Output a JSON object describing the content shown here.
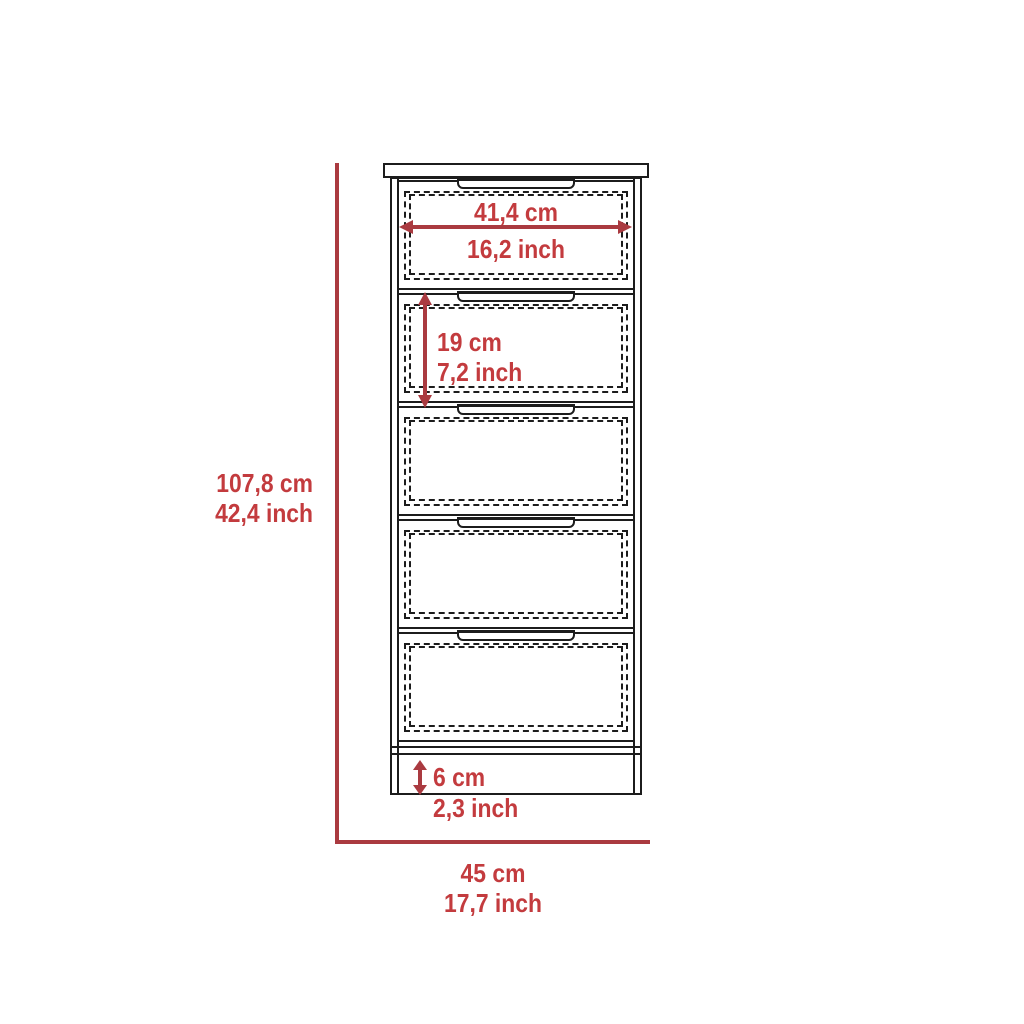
{
  "colors": {
    "dimension_line": "#aa3a40",
    "dimension_text": "#c33b3e",
    "outline": "#1c1c1c",
    "background": "#ffffff"
  },
  "diagram": {
    "object": "chest-of-drawers",
    "drawer_count": "5",
    "dimensions": {
      "overall_height": {
        "cm": "107,8 cm",
        "inch": "42,4 inch"
      },
      "overall_width": {
        "cm": "45 cm",
        "inch": "17,7 inch"
      },
      "drawer_width": {
        "cm": "41,4 cm",
        "inch": "16,2 inch"
      },
      "drawer_height": {
        "cm": "19 cm",
        "inch": "7,2 inch"
      },
      "base_height": {
        "cm": "6 cm",
        "inch": "2,3 inch"
      }
    }
  }
}
